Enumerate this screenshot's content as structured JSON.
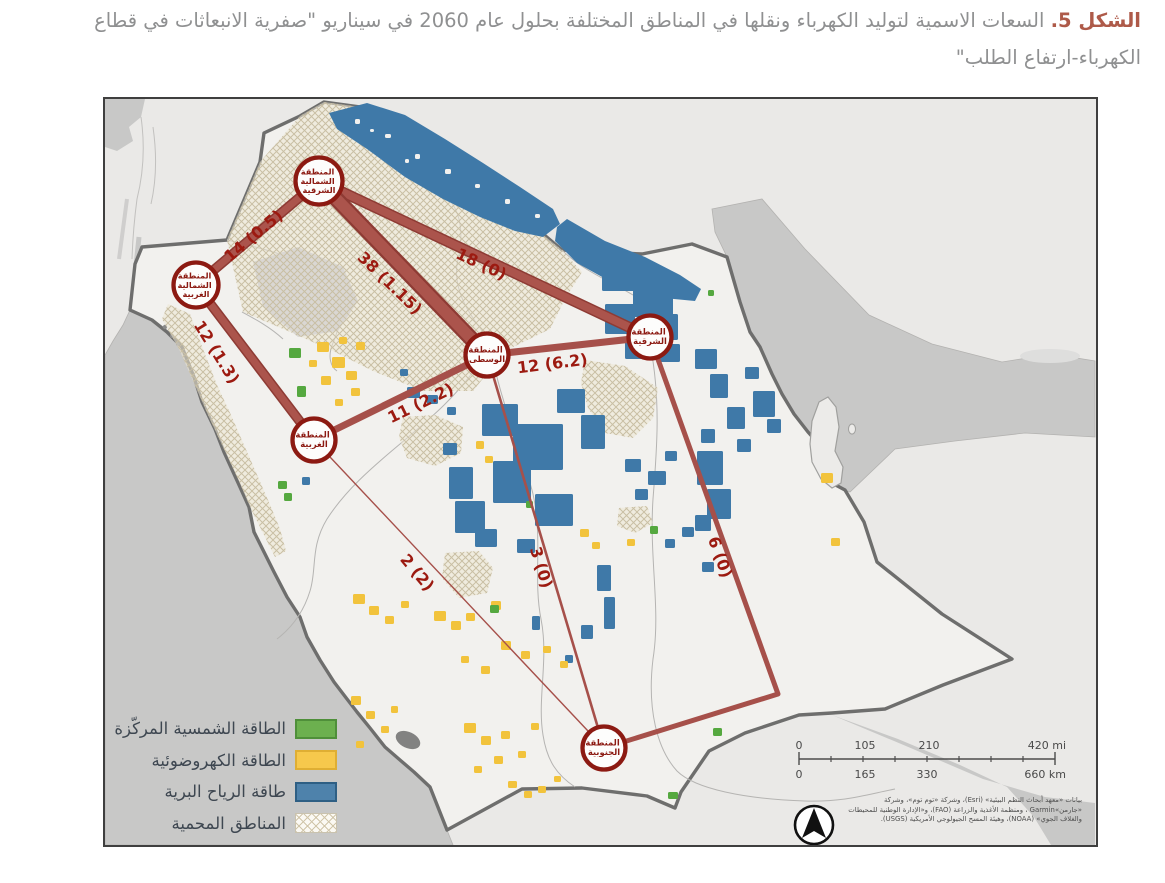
{
  "figure": {
    "label": "الشكل 5.",
    "caption": "السعات الاسمية لتوليد الكهرباء ونقلها في المناطق المختلفة بحلول عام 2060 في سيناريو \"صفرية الانبعاثات في قطاع الكهرباء-ارتفاع الطلب\""
  },
  "map": {
    "regions": [
      {
        "id": "northeast",
        "name": "المنطقة الشمالية الشرقية",
        "lines": [
          "المنطقة",
          "الشمالية",
          "الشرقية"
        ]
      },
      {
        "id": "northwest",
        "name": "المنطقة الشمالية الغربية",
        "lines": [
          "المنطقة",
          "الشمالية",
          "الغربية"
        ]
      },
      {
        "id": "central",
        "name": "المنطقة الوسطى",
        "lines": [
          "المنطقة",
          "الوسطى"
        ]
      },
      {
        "id": "eastern",
        "name": "المنطقة الشرقية",
        "lines": [
          "المنطقة",
          "الشرقية"
        ]
      },
      {
        "id": "western",
        "name": "المنطقة الغربية",
        "lines": [
          "المنطقة",
          "الغربية"
        ]
      },
      {
        "id": "southern",
        "name": "المنطقة الجنوبية",
        "lines": [
          "المنطقة",
          "الجنوبية"
        ]
      }
    ],
    "links": [
      {
        "from": "northwest",
        "to": "northeast",
        "label": "14 (0.5)"
      },
      {
        "from": "northeast",
        "to": "central",
        "label": "38 (1.15)"
      },
      {
        "from": "northeast",
        "to": "eastern",
        "label": "18 (0)"
      },
      {
        "from": "northwest",
        "to": "western",
        "label": "12 (1.3)"
      },
      {
        "from": "central",
        "to": "eastern",
        "label": "12 (6.2)"
      },
      {
        "from": "central",
        "to": "western",
        "label": "11 (2.2)"
      },
      {
        "from": "central",
        "to": "southern",
        "label": "3 (0)"
      },
      {
        "from": "western",
        "to": "southern",
        "label": "2 (2)"
      },
      {
        "from": "eastern",
        "to": "southern",
        "label": "6 (0)"
      }
    ],
    "legend": [
      {
        "label": "الطاقة الشمسية المركّزة",
        "color": "#6cb04f"
      },
      {
        "label": "الطاقة الكهروضوئية",
        "color": "#f6c84c"
      },
      {
        "label": "طاقة الرياح البرية",
        "color": "#4e82ab"
      },
      {
        "label": "المناطق المحمية",
        "color": "#efe9da",
        "pattern": "crosshatch"
      }
    ],
    "scale_bar": {
      "miles": [
        "0",
        "105",
        "210",
        "420 mi"
      ],
      "kilometers": [
        "0",
        "165",
        "330",
        "660 km"
      ]
    },
    "attribution": [
      "بيانات «معهد أبحاث النظم البيئية» (Esri)، وشركة «توم توم»، وشركة",
      "«جارمن»Garmin ، ومنظمة الأغذية والزراعة (FAO)، و«الإدارة الوطنية للمحيطات",
      "والغلاف الجوي» (NOAA)، وهيئة المسح الجيولوجي الأمريكية (USGS)."
    ],
    "north_arrow_icon": "north-arrow-icon",
    "colors": {
      "transmission_line": "#a6504a",
      "node_ring": "#8c1a12",
      "edge_label": "#9c1a10",
      "sea": "#c8c8c7",
      "saudi_land": "#f2f1ee",
      "neighbor_land": "#eae9e7",
      "wind": "#3f79a8",
      "pv": "#f2c33c",
      "csp": "#55a83f"
    }
  }
}
